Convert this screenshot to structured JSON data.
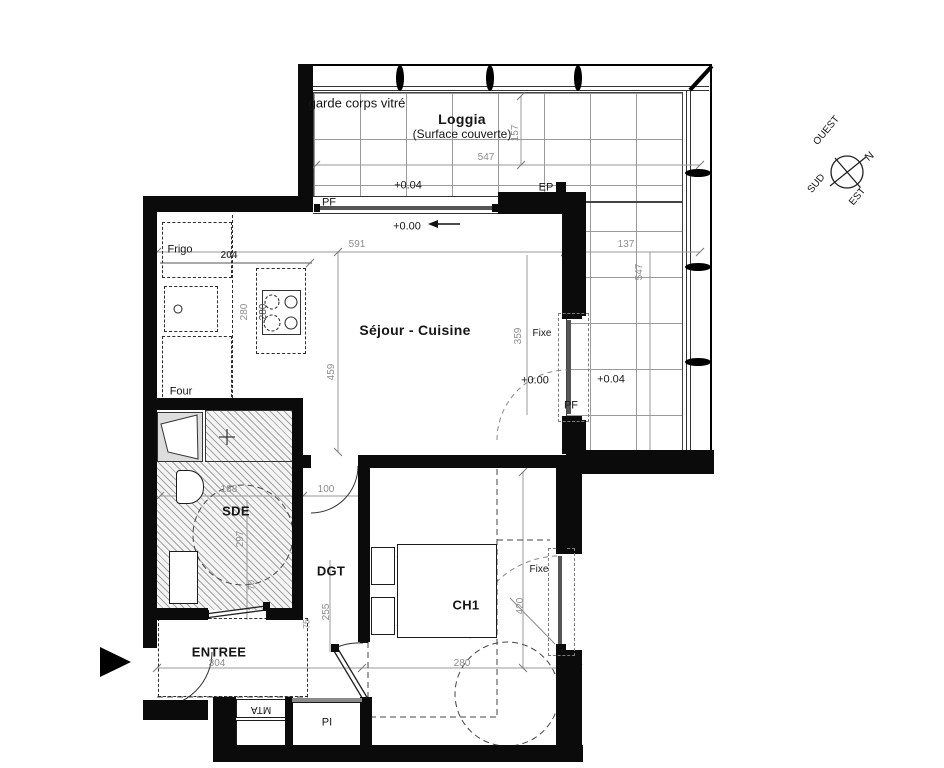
{
  "compass": {
    "west": "OUEST",
    "north": "N",
    "south": "SUD",
    "east": "EST"
  },
  "loggia": {
    "name": "Loggia",
    "subtitle": "(Surface couverte)",
    "railing": "garde corps vitré",
    "level": "+0.04",
    "level_right": "+0.04",
    "ep": "EP",
    "pf_right": "PF",
    "dim_width": "547",
    "dim_depth": "157",
    "dim_right_width": "137",
    "dim_right_height": "547"
  },
  "sejour": {
    "name": "Séjour - Cuisine",
    "pf_top": "PF",
    "level": "+0.00",
    "level_right": "+0.00",
    "fixe": "Fixe",
    "dim_width": "591",
    "dim_height": "459",
    "dim_right": "359"
  },
  "kitchen": {
    "fridge": "Frigo",
    "oven": "Four",
    "dim_width": "204",
    "dim_depth": "280",
    "dim_depth2": "280"
  },
  "sde": {
    "name": "SDE",
    "dim_width": "188",
    "dim_height": "297",
    "door_dim": "70"
  },
  "dgt": {
    "name": "DGT",
    "door_dim": "100",
    "dim_height": "255",
    "leaf_dim": "75"
  },
  "ch1": {
    "name": "CH1",
    "fixe": "Fixe",
    "dim_height": "420",
    "dim_width": "280"
  },
  "entree": {
    "name": "ENTREE",
    "dim_width": "304"
  },
  "technical": {
    "mta": "MTA",
    "pi": "PI"
  }
}
